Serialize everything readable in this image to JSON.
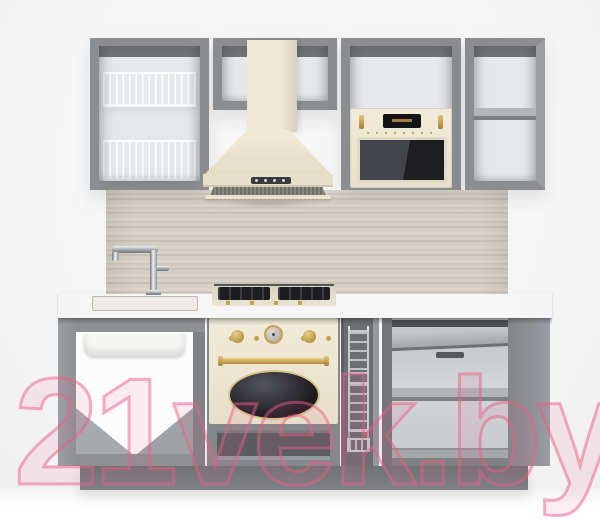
{
  "watermark": {
    "text": "21vek.by",
    "color": "#ec5d85"
  },
  "palette": {
    "background": "#f4f4f5",
    "carcass_gray": "#8a8e91",
    "carcass_dark": "#6e7275",
    "interior_light": "#e6e9eb",
    "appliance_cream": "#ebe4d0",
    "gold_trim": "#c7a24c",
    "chrome": "#c3c7ca",
    "countertop": "#e7e4dd",
    "backsplash_wood": "#d3ccc2",
    "dark_glass": "#222228",
    "watermark_pink": "#ec5d85"
  },
  "objects": [
    {
      "label": "Open wall cabinet with two dish drying racks"
    },
    {
      "label": "Short wall cabinet over cooker hood"
    },
    {
      "label": "Cream chimney cooker hood"
    },
    {
      "label": "Wall cabinet with built-in microwave"
    },
    {
      "label": "Built-in microwave oven, cream"
    },
    {
      "label": "Open wall cabinet with shelf"
    },
    {
      "label": "Wood-grain backsplash panel"
    },
    {
      "label": "Chrome kitchen faucet"
    },
    {
      "label": "Inset sink"
    },
    {
      "label": "Gas hob with cast-iron grates"
    },
    {
      "label": "Light stone countertop"
    },
    {
      "label": "Open sink base cabinet"
    },
    {
      "label": "Retro built-in oven, cream with gold trim"
    },
    {
      "label": "Pull-out wire bottle basket"
    },
    {
      "label": "Open base cabinet with shelf and pull-out tray"
    },
    {
      "label": "Plinth"
    }
  ]
}
